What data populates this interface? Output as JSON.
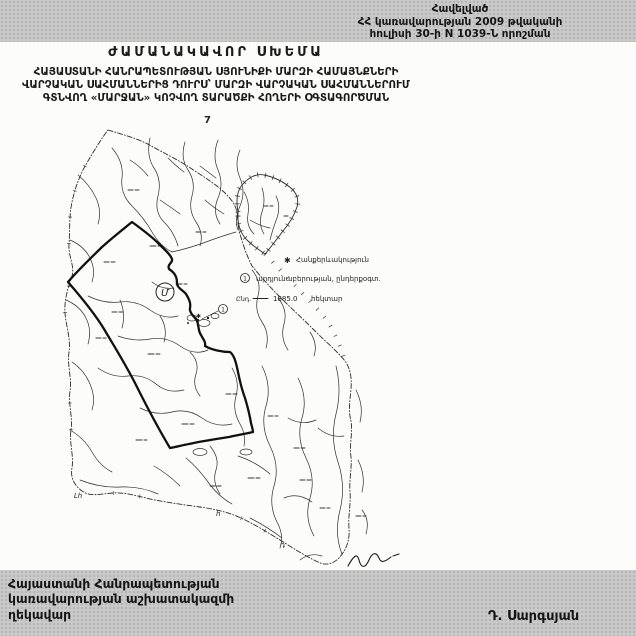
{
  "document": {
    "annex_header": {
      "lines": [
        "Հավելված",
        "ՀՀ կառավարության 2009 թվականի",
        "հուլիսի 30-ի N 1039-Ն որոշման"
      ]
    },
    "title": "ԺԱՄԱՆԱԿԱՎՈՐ ՍԽԵՄԱ",
    "subtitle_lines": [
      "ՀԱՅԱՍՏԱՆԻ ՀԱՆՐԱՊԵՏՈՒԹՅԱՆ ՍՅՈՒՆԻՔԻ ՄԱՐԶԻ ՀԱՄԱՅՆՔՆԵՐԻ",
      "ՎԱՐՉԱԿԱՆ ՍԱՀՄԱՆՆԵՐԻՑ ԴՈՒՐՍ՝ ՄԱՐԶԻ ՎԱՐՉԱԿԱՆ ՍԱՀՄԱՆՆԵՐՈՒՄ",
      "ԳՏՆՎՈՂ «ՄԱՐՋԱՆ» ԿՈՉՎՈՂ ՏԱՐԱԾՔԻ ՀՈՂԵՐԻ ՕԳՏԱԳՈՐԾՄԱՆ"
    ],
    "page_number": "7"
  },
  "map": {
    "legend": {
      "items": [
        {
          "marker": "✱",
          "label": "Հանքերևակություն"
        },
        {
          "marker": "1",
          "label": "արդյունաբերության, ընդերքօգտ."
        }
      ],
      "area": {
        "label": "Ընդ.",
        "value": "1885.0",
        "unit": "հեկտար"
      }
    },
    "circled_letter": "Մ",
    "point_marker": "1",
    "handwritten_marks": [
      "Լհ",
      "հ",
      "Դ"
    ]
  },
  "footer": {
    "org_lines": [
      "Հայաստանի Հանրապետության",
      "կառավարության աշխատակազմի",
      "ղեկավար"
    ],
    "signatory": "Դ. Սարգսյան"
  },
  "colors": {
    "band_gray": "#c9c9c9",
    "ink": "#1b1b1b",
    "map_line": "#2b2b2b"
  }
}
